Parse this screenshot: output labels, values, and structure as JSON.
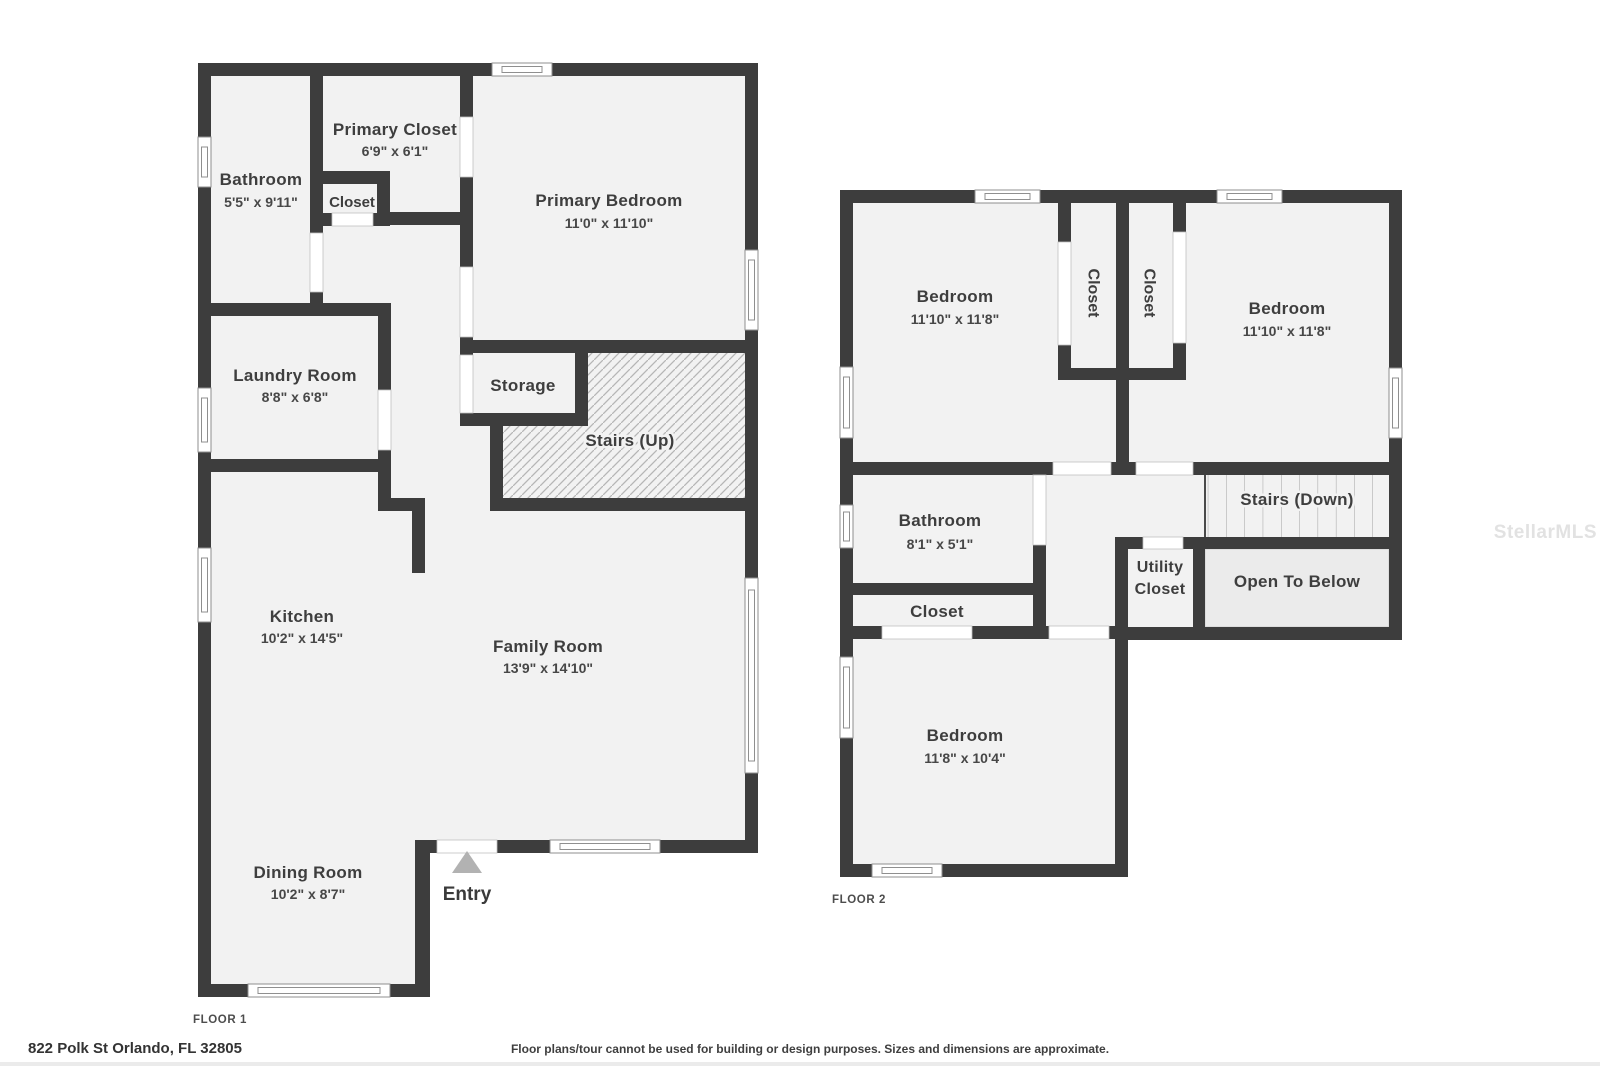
{
  "floor1": {
    "floor_label": "FLOOR 1",
    "rooms": {
      "bathroom": {
        "name": "Bathroom",
        "dims": "5'5\" x 9'11\""
      },
      "primary_closet": {
        "name": "Primary Closet",
        "dims": "6'9\" x 6'1\""
      },
      "closet": {
        "name": "Closet"
      },
      "primary_bedroom": {
        "name": "Primary Bedroom",
        "dims": "11'0\" x 11'10\""
      },
      "laundry": {
        "name": "Laundry Room",
        "dims": "8'8\" x 6'8\""
      },
      "storage": {
        "name": "Storage"
      },
      "stairs": {
        "name": "Stairs (Up)"
      },
      "kitchen": {
        "name": "Kitchen",
        "dims": "10'2\" x 14'5\""
      },
      "family": {
        "name": "Family Room",
        "dims": "13'9\" x 14'10\""
      },
      "dining": {
        "name": "Dining Room",
        "dims": "10'2\" x 8'7\""
      },
      "entry": {
        "name": "Entry"
      }
    }
  },
  "floor2": {
    "floor_label": "FLOOR 2",
    "rooms": {
      "bedroom_left": {
        "name": "Bedroom",
        "dims": "11'10\" x 11'8\""
      },
      "closet_left": {
        "name": "Closet"
      },
      "closet_right": {
        "name": "Closet"
      },
      "bedroom_right": {
        "name": "Bedroom",
        "dims": "11'10\" x 11'8\""
      },
      "bathroom": {
        "name": "Bathroom",
        "dims": "8'1\" x 5'1\""
      },
      "closet_hall": {
        "name": "Closet"
      },
      "utility_closet": {
        "name": "Utility Closet",
        "line1": "Utility",
        "line2": "Closet"
      },
      "stairs": {
        "name": "Stairs (Down)"
      },
      "open_to_below": {
        "name": "Open To Below"
      },
      "bedroom_bottom": {
        "name": "Bedroom",
        "dims": "11'8\" x 10'4\""
      }
    }
  },
  "footer": {
    "address": "822 Polk St Orlando, FL 32805",
    "disclaimer": "Floor plans/tour cannot be used for building or design purposes. Sizes and dimensions are approximate."
  },
  "watermark": "StellarMLS",
  "colors": {
    "wall": "#3d3d3d",
    "room_fill": "#f2f2f2",
    "open_to_below_fill": "#ebebeb"
  }
}
